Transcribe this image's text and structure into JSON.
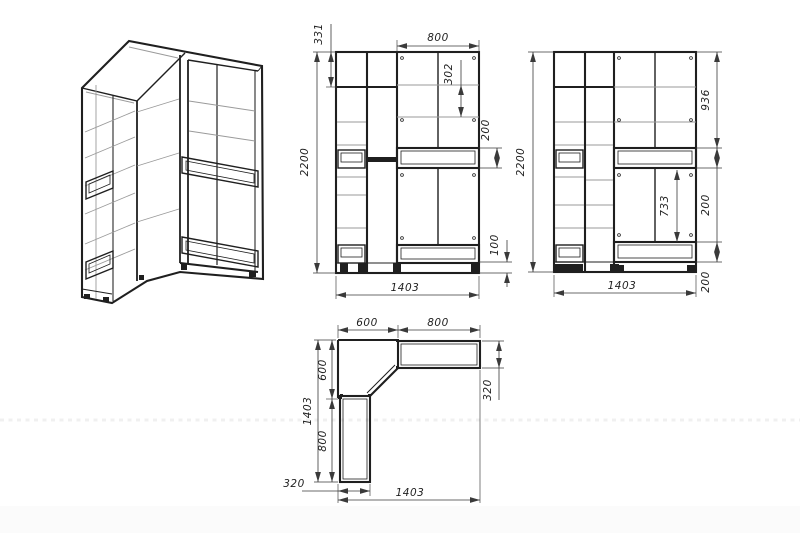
{
  "drawing": {
    "type": "furniture technical drawing - corner wardrobe",
    "colors": {
      "background": "#ffffff",
      "line": "#1f1f1f",
      "light_line": "#9a9a9a",
      "dim_line": "#3a3a3a",
      "text": "#1f1f1f"
    },
    "views": {
      "front": {
        "dims": {
          "total_height": "2200",
          "top_section": "331",
          "right_section_width": "800",
          "shelf_spacing": "302",
          "drawer_height": "200",
          "plinth_height": "100",
          "total_width": "1403"
        }
      },
      "side": {
        "dims": {
          "total_height": "2200",
          "upper_section": "936",
          "drawer_top": "200",
          "door_section": "733",
          "drawer_bottom": "200",
          "total_width": "1403"
        }
      },
      "plan": {
        "dims": {
          "corner_top_width": "600",
          "right_unit_width": "800",
          "corner_side_depth": "600",
          "total_depth": "1403",
          "left_unit_length": "800",
          "left_unit_width": "320",
          "right_unit_depth": "320",
          "total_width": "1403"
        }
      }
    }
  }
}
